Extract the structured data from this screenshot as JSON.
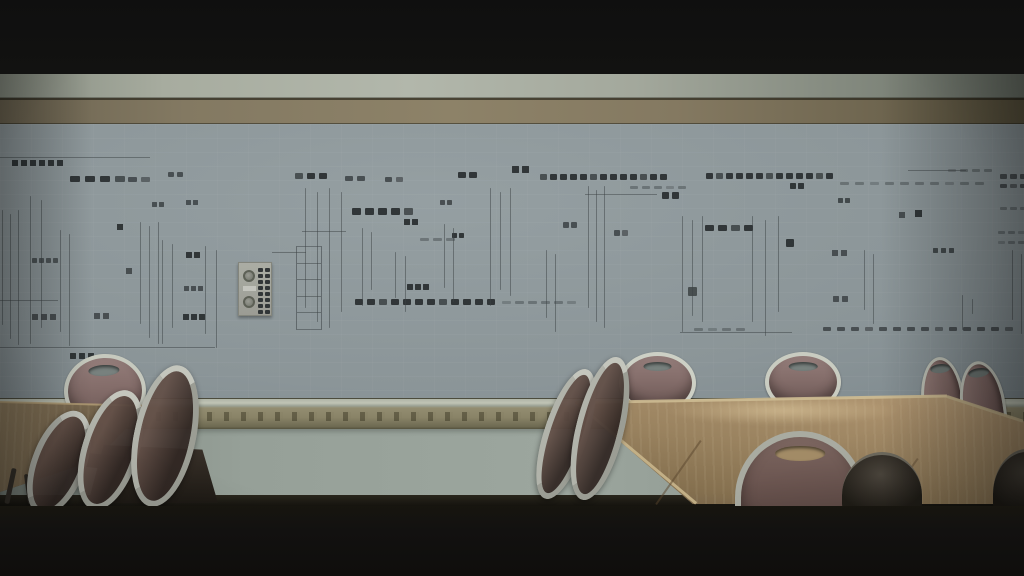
{
  "scene": {
    "type": "film-frame",
    "description": "Dim empty meeting room; wall-wide electrical schematic mural on tiled wall, tan ornamental frieze band, wood banquet tables, metal-framed chairs with mauve upholstery, black letterbox bars",
    "furniture": {
      "tables": 2,
      "chairs_behind_tables": 5,
      "chairs_in_foreground": 6,
      "dark_chair_silhouettes": 2
    }
  },
  "colors": {
    "letterbox": "#101010",
    "ceiling_strip": "#aab0a4",
    "wood_beam": "#857b63",
    "wall": "#8b9598",
    "frieze_band": "#8a8468",
    "lower_wall": "#98a19a",
    "floor_dark": "#171510",
    "table_wood_right": "#a98f6b",
    "table_wood_left": "#7d6c52",
    "chair_cushion": "#846d6a",
    "chair_frame_metal": "#c4c6bd",
    "schematic_dark": "#2c3133",
    "schematic_mid": "#454b4e",
    "schematic_light": "rgba(58,64,67,0.45)"
  },
  "wall_schematic": {
    "panel": {
      "t": "panel",
      "x": 238,
      "y": 262,
      "w": 34,
      "h": 54
    },
    "elements": [
      {
        "t": "grid",
        "x": 12,
        "y": 160,
        "r": 5,
        "c": 6,
        "s": 6,
        "g": 3,
        "col": "d"
      },
      {
        "t": "row",
        "x": 70,
        "y": 176,
        "n": 4,
        "w": 10,
        "h": 6,
        "g": 5,
        "col": "d"
      },
      {
        "t": "row",
        "x": 128,
        "y": 177,
        "n": 2,
        "w": 9,
        "h": 5,
        "g": 4,
        "col": "m"
      },
      {
        "t": "grid",
        "x": 152,
        "y": 202,
        "r": 3,
        "c": 2,
        "s": 5,
        "g": 2,
        "col": "m"
      },
      {
        "t": "row",
        "x": 168,
        "y": 172,
        "n": 2,
        "w": 6,
        "h": 5,
        "g": 3,
        "col": "m"
      },
      {
        "t": "row",
        "x": 295,
        "y": 173,
        "n": 3,
        "w": 8,
        "h": 6,
        "g": 4,
        "col": "d"
      },
      {
        "t": "row",
        "x": 345,
        "y": 176,
        "n": 2,
        "w": 8,
        "h": 5,
        "g": 4,
        "col": "m"
      },
      {
        "t": "row",
        "x": 385,
        "y": 177,
        "n": 2,
        "w": 7,
        "h": 5,
        "g": 4,
        "col": "m"
      },
      {
        "t": "row",
        "x": 458,
        "y": 172,
        "n": 2,
        "w": 8,
        "h": 6,
        "g": 3,
        "col": "d"
      },
      {
        "t": "grid",
        "x": 512,
        "y": 166,
        "r": 3,
        "c": 2,
        "s": 7,
        "g": 3,
        "col": "d"
      },
      {
        "t": "row",
        "x": 540,
        "y": 174,
        "n": 13,
        "w": 7,
        "h": 6,
        "g": 3,
        "col": "d"
      },
      {
        "t": "row",
        "x": 630,
        "y": 186,
        "n": 5,
        "w": 8,
        "h": 3,
        "g": 4,
        "col": "l"
      },
      {
        "t": "row",
        "x": 706,
        "y": 173,
        "n": 13,
        "w": 7,
        "h": 6,
        "g": 3,
        "col": "d"
      },
      {
        "t": "grid",
        "x": 790,
        "y": 183,
        "r": 2,
        "c": 2,
        "s": 6,
        "g": 2,
        "col": "d"
      },
      {
        "t": "row",
        "x": 840,
        "y": 182,
        "n": 10,
        "w": 9,
        "h": 3,
        "g": 6,
        "col": "l"
      },
      {
        "t": "row",
        "x": 948,
        "y": 169,
        "n": 4,
        "w": 8,
        "h": 3,
        "g": 4,
        "col": "l"
      },
      {
        "t": "row",
        "x": 1000,
        "y": 174,
        "n": 3,
        "w": 7,
        "h": 5,
        "g": 3,
        "col": "m"
      },
      {
        "t": "row",
        "x": 1000,
        "y": 184,
        "n": 3,
        "w": 7,
        "h": 4,
        "g": 3,
        "col": "m"
      },
      {
        "t": "vc",
        "x": 117,
        "y": 224,
        "n": 17,
        "s": 6,
        "g": 1,
        "col": "d"
      },
      {
        "t": "vc",
        "x": 126,
        "y": 268,
        "n": 9,
        "s": 6,
        "g": 1,
        "col": "m"
      },
      {
        "t": "grid",
        "x": 186,
        "y": 200,
        "r": 4,
        "c": 2,
        "s": 5,
        "g": 2,
        "col": "m"
      },
      {
        "t": "grid",
        "x": 186,
        "y": 252,
        "r": 4,
        "c": 2,
        "s": 6,
        "g": 2,
        "col": "d"
      },
      {
        "t": "grid",
        "x": 184,
        "y": 286,
        "r": 4,
        "c": 3,
        "s": 5,
        "g": 2,
        "col": "m"
      },
      {
        "t": "grid",
        "x": 183,
        "y": 314,
        "r": 4,
        "c": 3,
        "s": 6,
        "g": 2,
        "col": "d"
      },
      {
        "t": "grid",
        "x": 32,
        "y": 314,
        "r": 4,
        "c": 3,
        "s": 6,
        "g": 3,
        "col": "m"
      },
      {
        "t": "grid",
        "x": 94,
        "y": 313,
        "r": 4,
        "c": 2,
        "s": 6,
        "g": 3,
        "col": "m"
      },
      {
        "t": "grid",
        "x": 70,
        "y": 353,
        "r": 3,
        "c": 3,
        "s": 6,
        "g": 3,
        "col": "d"
      },
      {
        "t": "grid",
        "x": 32,
        "y": 258,
        "r": 3,
        "c": 4,
        "s": 5,
        "g": 2,
        "col": "l"
      },
      {
        "t": "row",
        "x": 352,
        "y": 208,
        "n": 5,
        "w": 9,
        "h": 7,
        "g": 4,
        "col": "d"
      },
      {
        "t": "grid",
        "x": 404,
        "y": 219,
        "r": 4,
        "c": 2,
        "s": 6,
        "g": 2,
        "col": "d"
      },
      {
        "t": "grid",
        "x": 440,
        "y": 200,
        "r": 2,
        "c": 2,
        "s": 5,
        "g": 2,
        "col": "m"
      },
      {
        "t": "row",
        "x": 420,
        "y": 238,
        "n": 3,
        "w": 9,
        "h": 3,
        "g": 4,
        "col": "l"
      },
      {
        "t": "grid",
        "x": 452,
        "y": 233,
        "r": 2,
        "c": 2,
        "s": 5,
        "g": 2,
        "col": "d"
      },
      {
        "t": "grid",
        "x": 407,
        "y": 284,
        "r": 3,
        "c": 3,
        "s": 6,
        "g": 2,
        "col": "d"
      },
      {
        "t": "row",
        "x": 355,
        "y": 299,
        "n": 12,
        "w": 8,
        "h": 6,
        "g": 4,
        "col": "d"
      },
      {
        "t": "row",
        "x": 502,
        "y": 301,
        "n": 6,
        "w": 9,
        "h": 3,
        "g": 4,
        "col": "l"
      },
      {
        "t": "grid",
        "x": 563,
        "y": 222,
        "r": 1,
        "c": 2,
        "s": 6,
        "g": 2,
        "col": "m"
      },
      {
        "t": "grid",
        "x": 614,
        "y": 230,
        "r": 1,
        "c": 2,
        "s": 6,
        "g": 2,
        "col": "m"
      },
      {
        "t": "grid",
        "x": 662,
        "y": 192,
        "r": 1,
        "c": 2,
        "s": 7,
        "g": 3,
        "col": "d"
      },
      {
        "t": "row",
        "x": 705,
        "y": 225,
        "n": 4,
        "w": 9,
        "h": 6,
        "g": 4,
        "col": "d"
      },
      {
        "t": "grid",
        "x": 688,
        "y": 287,
        "r": 1,
        "c": 1,
        "s": 9,
        "g": 0,
        "col": "d"
      },
      {
        "t": "grid",
        "x": 786,
        "y": 239,
        "r": 1,
        "c": 1,
        "s": 8,
        "g": 0,
        "col": "d"
      },
      {
        "t": "grid",
        "x": 838,
        "y": 198,
        "r": 5,
        "c": 2,
        "s": 5,
        "g": 2,
        "col": "l"
      },
      {
        "t": "vc",
        "x": 899,
        "y": 212,
        "n": 13,
        "s": 6,
        "g": 2,
        "col": "m"
      },
      {
        "t": "vc",
        "x": 915,
        "y": 210,
        "n": 13,
        "s": 7,
        "g": 2,
        "col": "d"
      },
      {
        "t": "grid",
        "x": 832,
        "y": 250,
        "r": 5,
        "c": 2,
        "s": 6,
        "g": 3,
        "col": "m"
      },
      {
        "t": "grid",
        "x": 833,
        "y": 296,
        "r": 2,
        "c": 2,
        "s": 6,
        "g": 3,
        "col": "m"
      },
      {
        "t": "grid",
        "x": 933,
        "y": 248,
        "r": 5,
        "c": 3,
        "s": 5,
        "g": 3,
        "col": "l"
      },
      {
        "t": "row",
        "x": 1000,
        "y": 207,
        "n": 3,
        "w": 7,
        "h": 3,
        "g": 3,
        "col": "l"
      },
      {
        "t": "row",
        "x": 998,
        "y": 231,
        "n": 3,
        "w": 7,
        "h": 3,
        "g": 3,
        "col": "l"
      },
      {
        "t": "row",
        "x": 998,
        "y": 241,
        "n": 3,
        "w": 7,
        "h": 3,
        "g": 3,
        "col": "l"
      },
      {
        "t": "row",
        "x": 823,
        "y": 327,
        "n": 14,
        "w": 8,
        "h": 4,
        "g": 6,
        "col": "m"
      },
      {
        "t": "row",
        "x": 694,
        "y": 328,
        "n": 4,
        "w": 9,
        "h": 3,
        "g": 5,
        "col": "l"
      },
      {
        "t": "vl",
        "x": 2,
        "y": 210,
        "h": 135,
        "n": 3,
        "g": 7
      },
      {
        "t": "vl",
        "x": 30,
        "y": 196,
        "h": 148,
        "n": 2,
        "g": 10
      },
      {
        "t": "vl",
        "x": 60,
        "y": 230,
        "h": 112,
        "n": 2,
        "g": 8
      },
      {
        "t": "vl",
        "x": 140,
        "y": 222,
        "h": 122,
        "n": 3,
        "g": 8
      },
      {
        "t": "vl",
        "x": 162,
        "y": 240,
        "h": 104,
        "n": 2,
        "g": 9
      },
      {
        "t": "vl",
        "x": 205,
        "y": 246,
        "h": 98,
        "n": 2,
        "g": 10
      },
      {
        "t": "vl",
        "x": 305,
        "y": 188,
        "h": 140,
        "n": 4,
        "g": 11
      },
      {
        "t": "vl",
        "x": 362,
        "y": 228,
        "h": 78,
        "n": 2,
        "g": 8
      },
      {
        "t": "vl",
        "x": 395,
        "y": 252,
        "h": 56,
        "n": 2,
        "g": 9
      },
      {
        "t": "vl",
        "x": 444,
        "y": 224,
        "h": 84,
        "n": 2,
        "g": 8
      },
      {
        "t": "vl",
        "x": 490,
        "y": 188,
        "h": 118,
        "n": 3,
        "g": 9
      },
      {
        "t": "vl",
        "x": 546,
        "y": 250,
        "h": 78,
        "n": 2,
        "g": 8
      },
      {
        "t": "vl",
        "x": 588,
        "y": 186,
        "h": 142,
        "n": 3,
        "g": 7
      },
      {
        "t": "vl",
        "x": 682,
        "y": 216,
        "h": 116,
        "n": 3,
        "g": 9
      },
      {
        "t": "vl",
        "x": 752,
        "y": 216,
        "h": 116,
        "n": 3,
        "g": 12
      },
      {
        "t": "vl",
        "x": 864,
        "y": 250,
        "h": 80,
        "n": 2,
        "g": 8
      },
      {
        "t": "vl",
        "x": 962,
        "y": 295,
        "h": 35,
        "n": 2,
        "g": 9
      },
      {
        "t": "vl",
        "x": 1012,
        "y": 250,
        "h": 80,
        "n": 2,
        "g": 8
      },
      {
        "t": "lad",
        "x": 296,
        "y": 246,
        "w": 26,
        "h": 84,
        "rungs": 6
      },
      {
        "t": "hl",
        "x": 0,
        "y": 157,
        "w": 150
      },
      {
        "t": "hl",
        "x": 0,
        "y": 347,
        "w": 215
      },
      {
        "t": "hl",
        "x": 0,
        "y": 300,
        "w": 58
      },
      {
        "t": "hl",
        "x": 272,
        "y": 252,
        "w": 34
      },
      {
        "t": "hl",
        "x": 302,
        "y": 231,
        "w": 44
      },
      {
        "t": "hl",
        "x": 585,
        "y": 194,
        "w": 72
      },
      {
        "t": "hl",
        "x": 680,
        "y": 332,
        "w": 112
      },
      {
        "t": "hl",
        "x": 908,
        "y": 170,
        "w": 58
      }
    ]
  }
}
